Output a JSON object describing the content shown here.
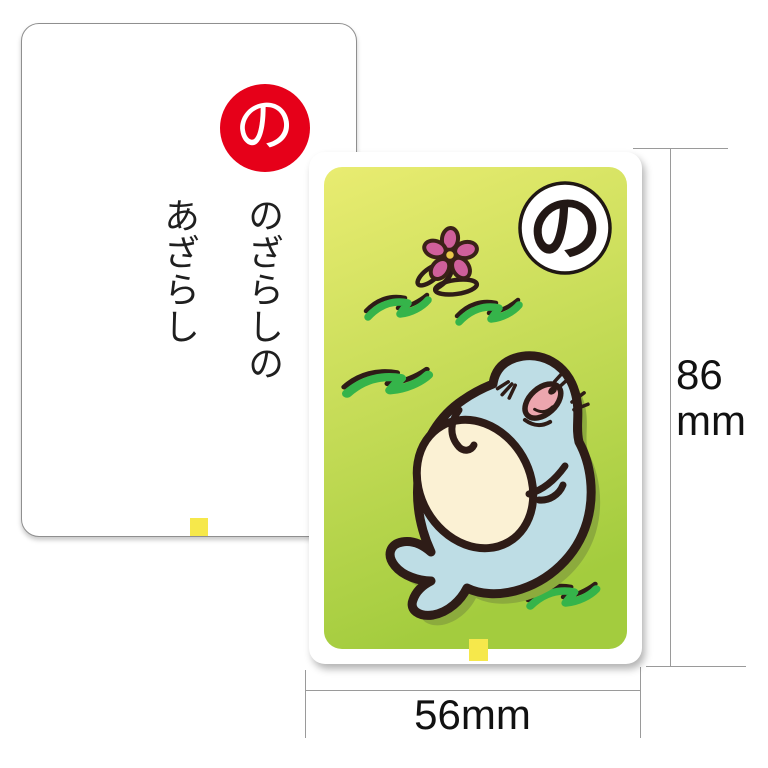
{
  "reading_card": {
    "kana": "の",
    "phrase_line_1": "のざらしの",
    "phrase_line_2": "あざらし",
    "badge_color": "#e60019",
    "text_color": "#1f1f1f",
    "tab_color": "#f6e84b"
  },
  "picture_card": {
    "kana": "の",
    "kana_circle_fill": "#ffffff",
    "kana_color": "#231815",
    "tab_color": "#f6e84b",
    "bg_gradient_top": "#e9ec71",
    "bg_gradient_bottom": "#a3cc3e",
    "illustration": {
      "subject": "seal lying on grass",
      "body_color": "#bedde5",
      "belly_color": "#fbf1d4",
      "snout_color": "#eca6ae",
      "outline_color": "#2e1c17",
      "shadow_color": "#8cab3d",
      "grass_color": "#35b44a",
      "flower_petal_color": "#cf5f9b",
      "flower_center_color": "#e8c84a"
    }
  },
  "dimensions": {
    "height_value": "86",
    "height_unit": "mm",
    "width_label": "56mm",
    "line_color": "#9a9a9a"
  }
}
